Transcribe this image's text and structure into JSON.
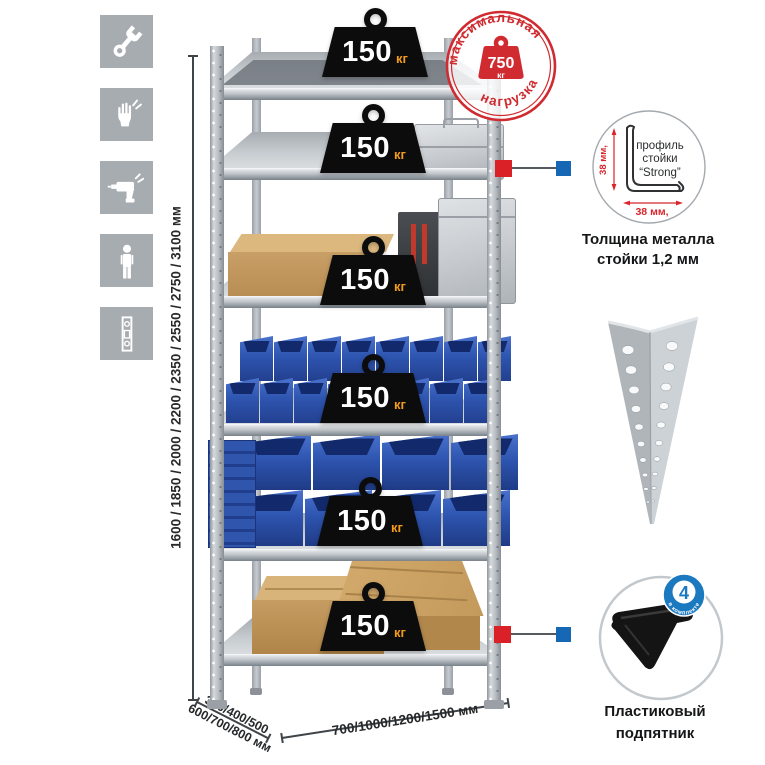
{
  "icons_column": {
    "bg_color": "#a7acb1",
    "items": [
      {
        "name": "wrench"
      },
      {
        "name": "work-gloves"
      },
      {
        "name": "drill"
      },
      {
        "name": "person-height"
      },
      {
        "name": "rack-post"
      }
    ]
  },
  "dimensions": {
    "height_label": "1600 / 1850 / 2000 / 2200 / 2350 / 2550 / 2750 / 3100 мм",
    "depth_line1": "300/400/500",
    "depth_line2": "600/700/800 мм",
    "width_label": "700/1000/1200/1500 мм"
  },
  "shelving": {
    "shelf_count": 6,
    "per_shelf_load": {
      "value": "150",
      "unit": "кг"
    },
    "contents": [
      "empty",
      "aluminum case",
      "cardboard box and aluminum cases",
      "small blue bins",
      "large blue bins",
      "cardboard boxes"
    ],
    "small_bin_rows": [
      8,
      8
    ],
    "large_bin_rows": [
      4,
      4
    ]
  },
  "max_load_stamp": {
    "arc_top": "максимальная",
    "arc_bottom": "нагрузка",
    "value": "750",
    "unit": "кг",
    "color": "#cf2b30"
  },
  "post_profile_detail": {
    "dim_vertical": "38 мм,",
    "dim_horizontal": "38 мм,",
    "label_line1": "профиль",
    "label_line2": "стойки",
    "label_line3": "“Strong”",
    "caption_line1": "Толщина металла",
    "caption_line2": "стойки 1,2 мм"
  },
  "foot_detail": {
    "badge_value": "4",
    "badge_arc": "в комплекте",
    "caption_line1": "Пластиковый",
    "caption_line2": "подпятник"
  },
  "colors": {
    "accent_red": "#cf2b30",
    "marker_red": "#da2128",
    "marker_blue": "#1668b5",
    "badge_blue": "#1b79c0",
    "bin_blue": "#2e55b0",
    "metal_gray": "#b9bec3",
    "weight_black": "#0c0c0c",
    "weight_unit_orange": "#f29b1d"
  }
}
